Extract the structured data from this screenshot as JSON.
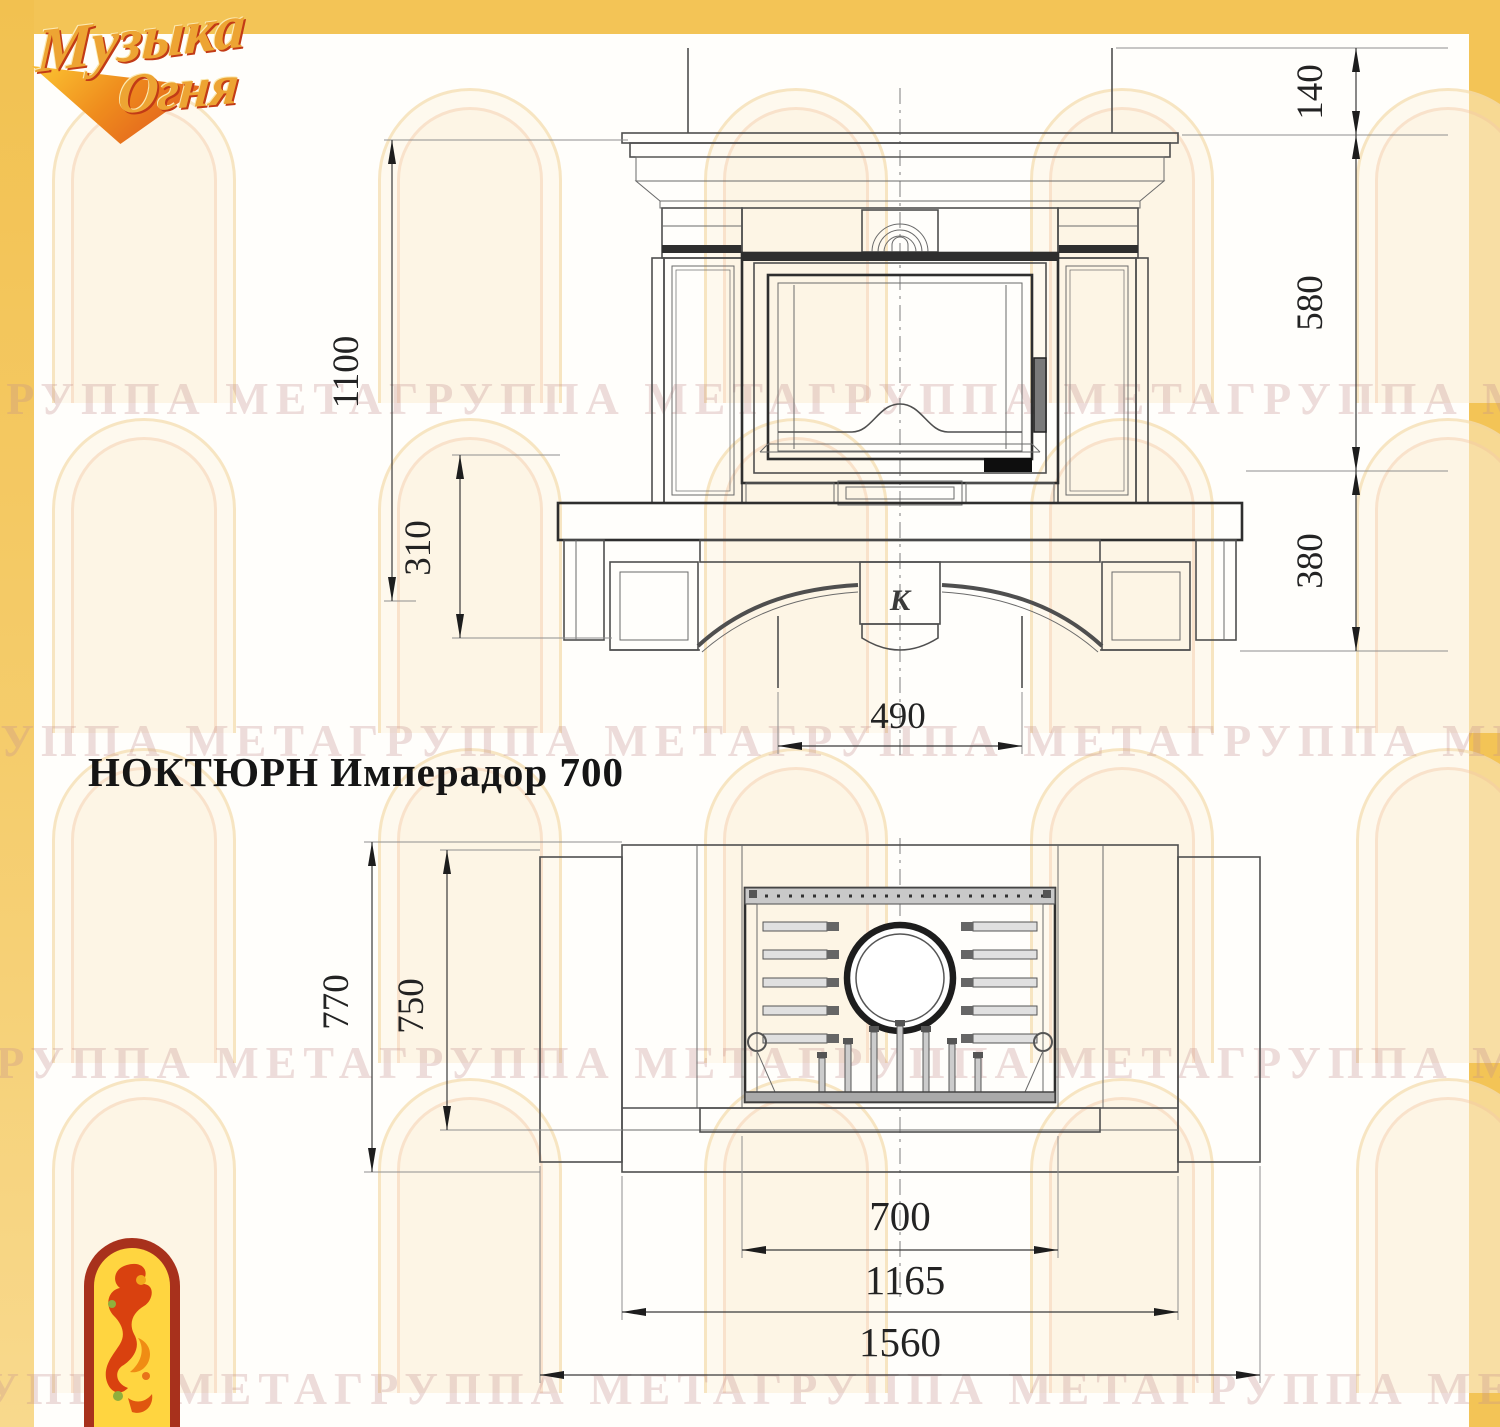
{
  "brand": {
    "line1": "Музыка",
    "line2": "Огня"
  },
  "title": "НОКТЮРН Имперадор 700",
  "watermark": {
    "text": "ГРУППА МЕТАГРУППА МЕТАГРУППА МЕТАГРУППА МЕТА"
  },
  "front_view": {
    "dim_right_top": "140",
    "dim_right_middle": "580",
    "dim_right_bottom": "380",
    "dim_left_height": "1100",
    "dim_left_base": "310",
    "dim_bottom_width": "490",
    "emblem": "К"
  },
  "plan_view": {
    "dim_left_outer_depth": "770",
    "dim_left_inner_depth": "750",
    "dim_insert_width": "700",
    "dim_body_width": "1165",
    "dim_overall_width": "1560"
  },
  "colors": {
    "page_border": "#F3C456",
    "logo_gold": "#EDA433",
    "logo_red": "#C23B16",
    "line": "#4F4F4F",
    "dim_text": "#232323"
  }
}
